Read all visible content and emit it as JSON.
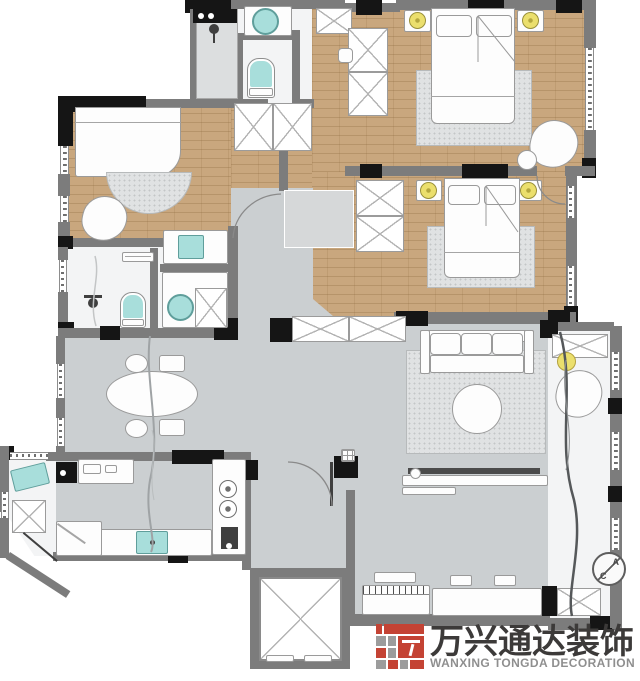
{
  "logo": {
    "brand_cn": "万兴通达装饰",
    "brand_en": "WANXING TONGDA DECORATION"
  },
  "annotations": {
    "ac_letter_top": "A",
    "ac_letter_bottom": "C"
  },
  "palette": {
    "wall": "#7c7c7c",
    "column": "#151515",
    "wood": "#c9a77e",
    "tile": "#cbcfd1",
    "marble": "#f3f4f5",
    "fixture_teal": "#a8dedb",
    "fixture_teal_dark": "#5f9e9b",
    "lamp_yellow": "#ebdf6d",
    "rug": "#e0e2e3",
    "furniture_line": "#9a9a9a",
    "accent_red": "#c44334",
    "logo_text_dark": "#3c3a39",
    "logo_text_gray": "#8f8f8f"
  }
}
